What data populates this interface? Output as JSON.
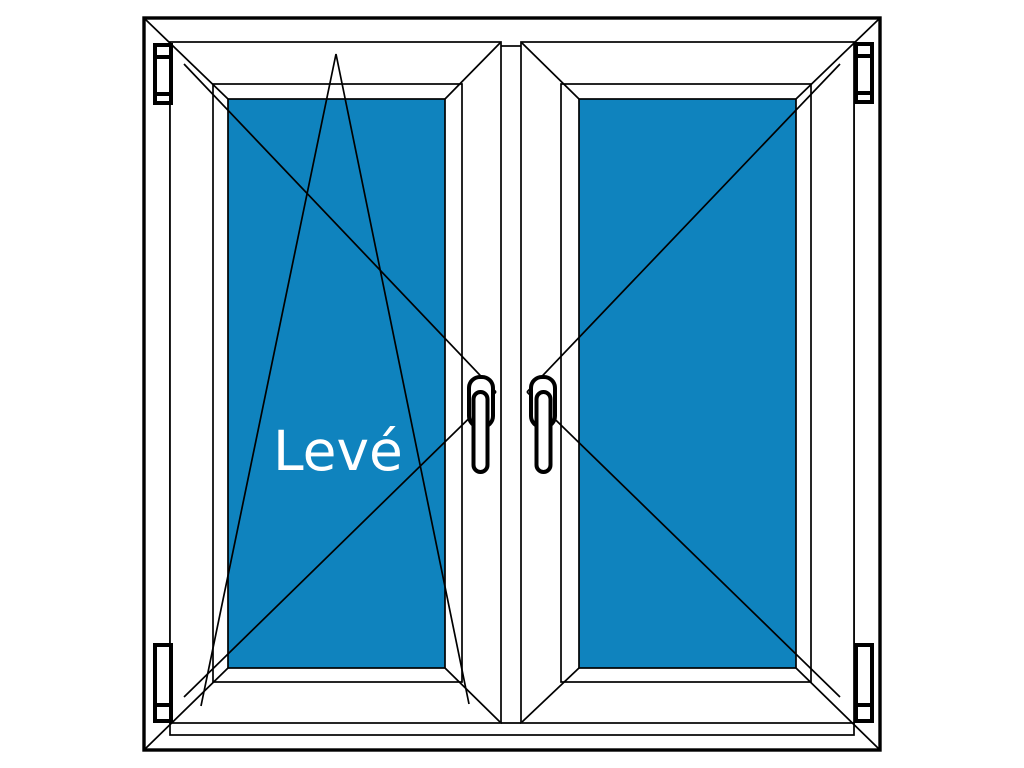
{
  "diagram": {
    "label": "Levé",
    "panes": {
      "left": {
        "opening": "tilt-and-turn",
        "hinge_side": "left"
      },
      "right": {
        "opening": "turn",
        "hinge_side": "right"
      }
    }
  },
  "colors": {
    "background": "#ffffff",
    "fill": "#ffffff",
    "line": "#000000",
    "glass": "#0f83be",
    "label": "#ffffff"
  }
}
